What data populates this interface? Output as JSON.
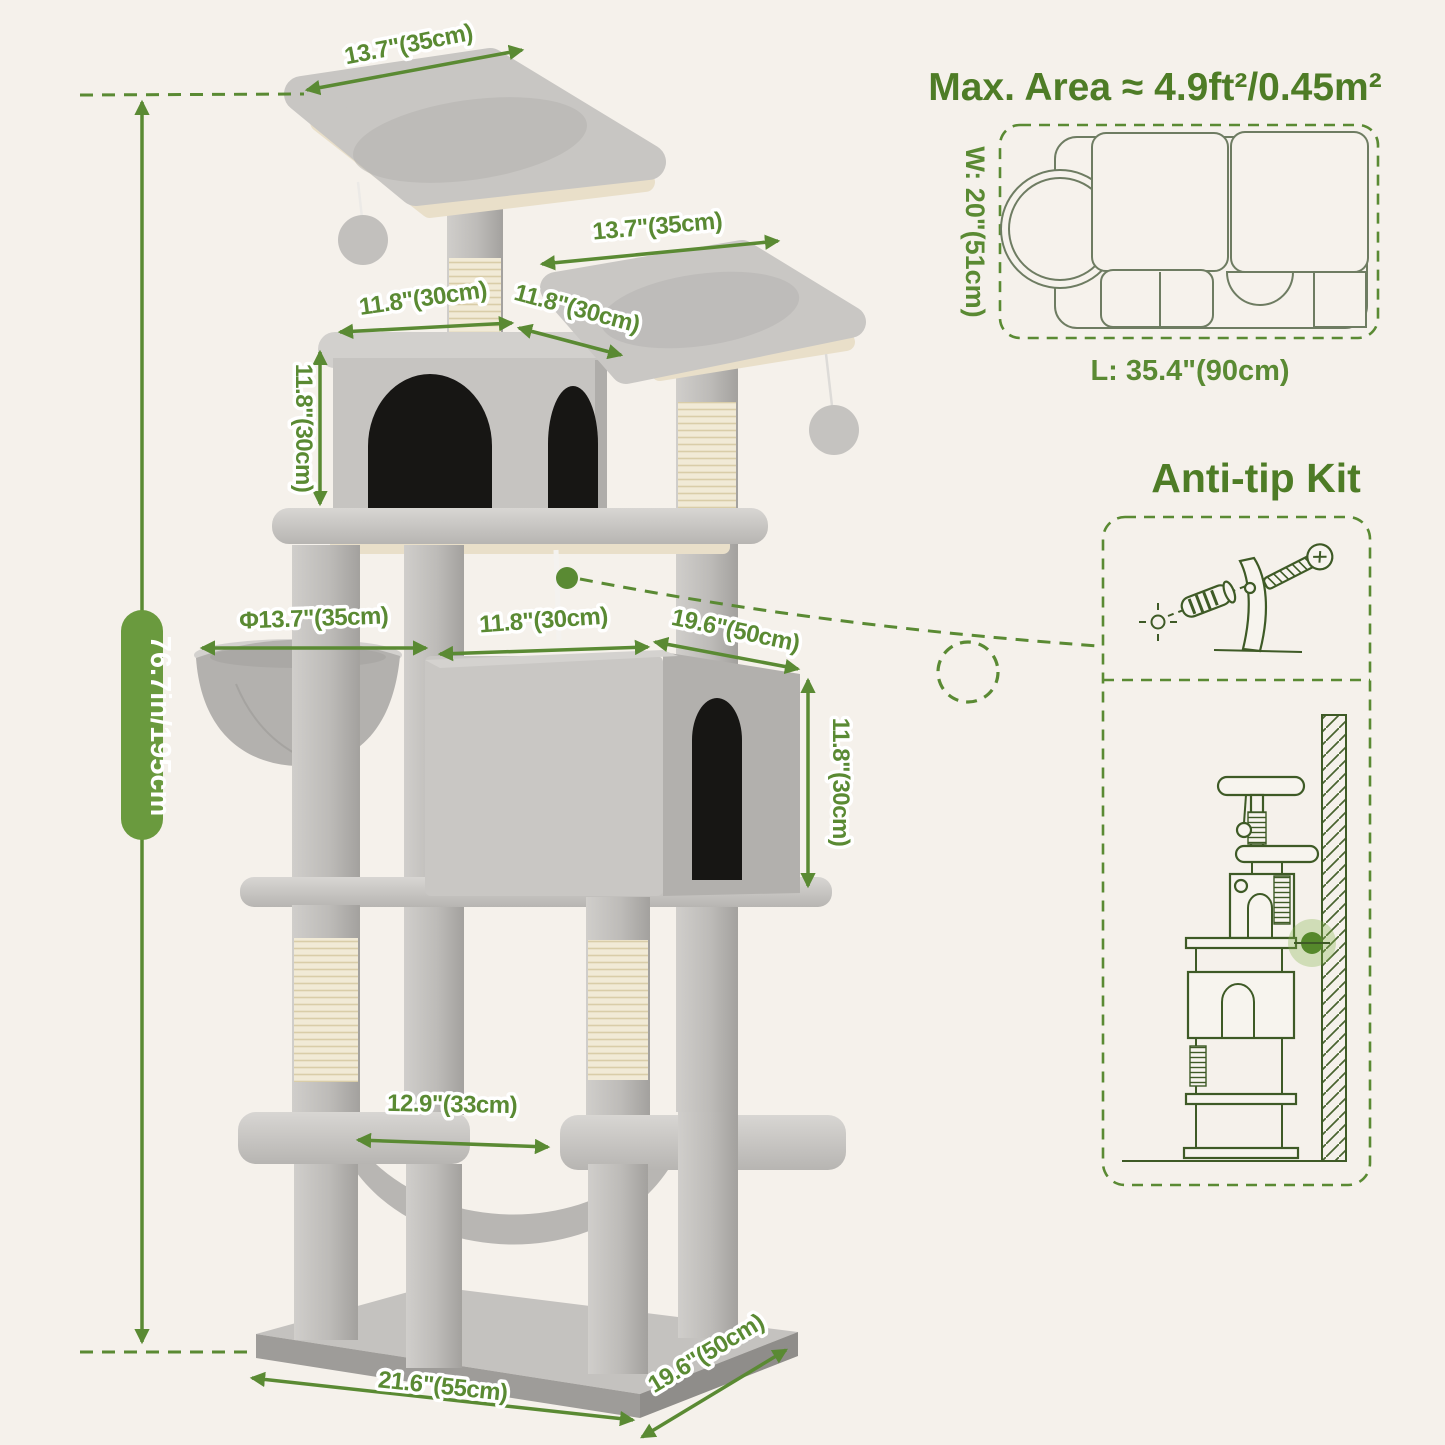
{
  "labels": {
    "top_platform": "13.7\"(35cm)",
    "second_platform": "13.7\"(35cm)",
    "condo_top_left": "11.8\"(30cm)",
    "condo_top_right": "11.8\"(30cm)",
    "condo_height": "11.8\"(30cm)",
    "overall_height": "76.7in/195cm",
    "basket_diameter": "Φ13.7\"(35cm)",
    "mid_width": "11.8\"(30cm)",
    "big_condo_width": "19.6\"(50cm)",
    "big_condo_height": "11.8\"(30cm)",
    "hammock_width": "12.9\"(33cm)",
    "base_length": "21.6\"(55cm)",
    "base_depth": "19.6\"(50cm)"
  },
  "max_area": {
    "title": "Max. Area ≈ 4.9ft²/0.45m²",
    "width_label": "W: 20\"(51cm)",
    "length_label": "L: 35.4\"(90cm)"
  },
  "anti_tip": {
    "title": "Anti-tip Kit"
  },
  "colors": {
    "accent_green": "#5a8a33",
    "title_green": "#4e7c26",
    "badge_green": "#6a9a3e",
    "drawing_green": "#3e5a26",
    "background": "#f5f1eb"
  }
}
